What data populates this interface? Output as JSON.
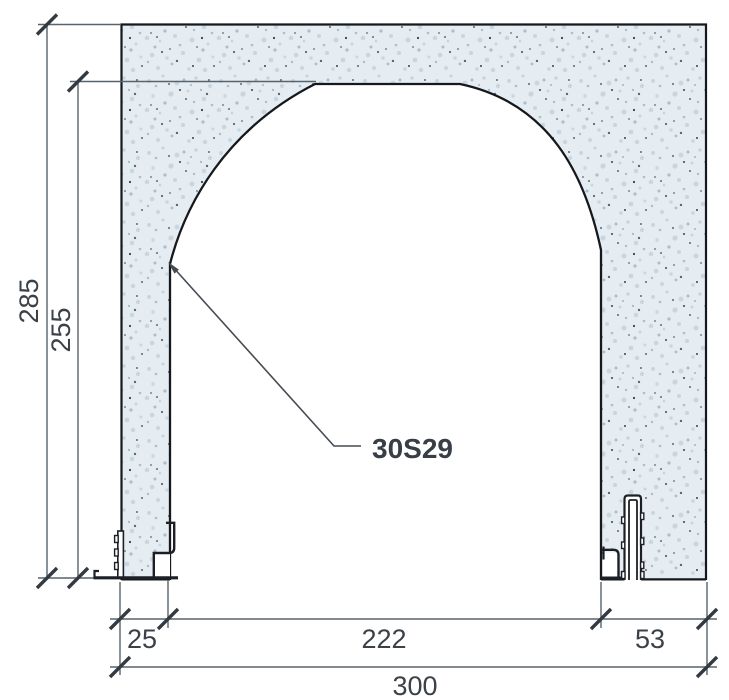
{
  "drawing": {
    "profile_label": "30S29",
    "dimensions": {
      "total_height": "285",
      "opening_height": "255",
      "left_jamb_width": "25",
      "opening_width": "222",
      "right_jamb_width": "53",
      "total_width": "300"
    },
    "colors": {
      "masonry_base": "#e5edf3",
      "speckle_light": "#c9d6e0",
      "speckle_mid": "#aabfcd",
      "speckle_dark": "#5a6872",
      "speckle_darkest": "#39434c",
      "outline": "#15181c",
      "profile_line": "#1c2026",
      "dimension_line": "#59636c",
      "tick": "#333a41",
      "text": "#3b4148",
      "label_text": "#383e46"
    }
  }
}
